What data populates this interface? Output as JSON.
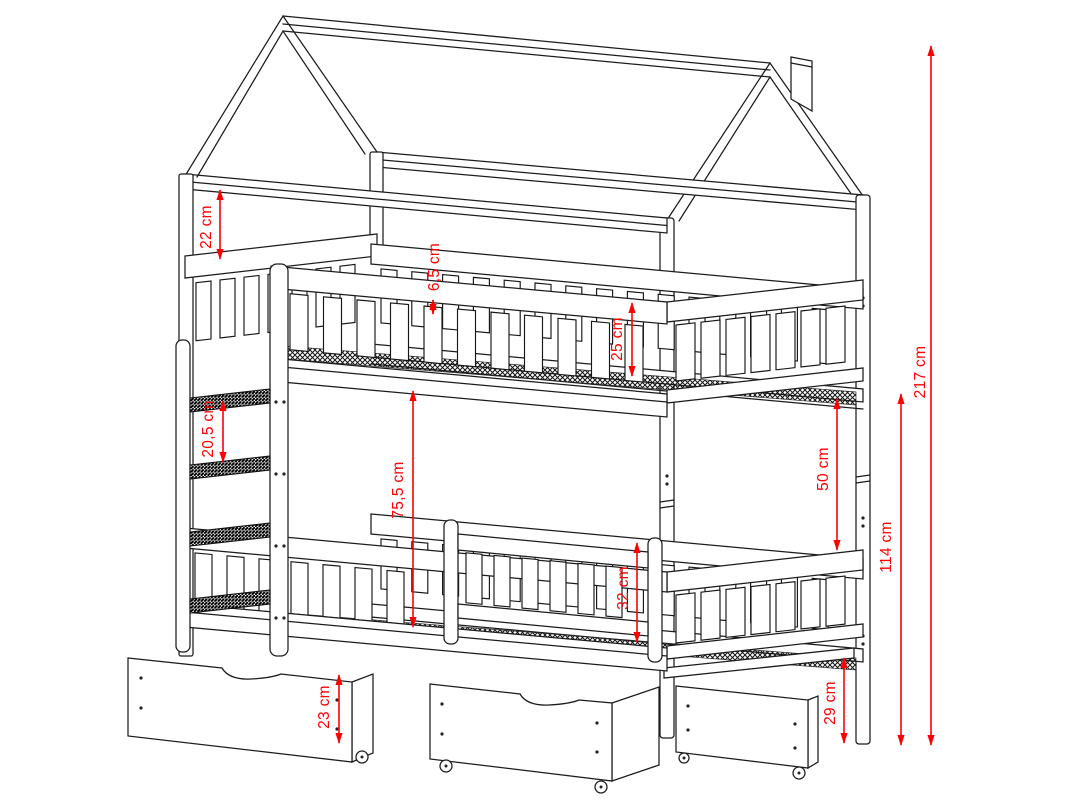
{
  "figure": {
    "type": "technical-drawing",
    "subject": "House-frame bunk bed with slatted guardrails, side ladder, chimney detail and two under-bed storage drawers on casters",
    "unit": "cm"
  },
  "colors": {
    "background": "#ffffff",
    "line_art": "#1c1c1c",
    "dimension_red": "#ff0000"
  },
  "dimensions": [
    {
      "id": "headboard-panel-height",
      "label": "22 cm",
      "x": 220,
      "y1": 189,
      "y2": 260,
      "lx": 207,
      "ly": 227
    },
    {
      "id": "top-rail-width",
      "label": "6,5 cm",
      "x": 433,
      "y1": 299,
      "y2": 315,
      "lx": 435,
      "ly": 267
    },
    {
      "id": "upper-guardrail-height",
      "label": "25 cm",
      "x": 632,
      "y1": 302,
      "y2": 377,
      "lx": 618,
      "ly": 339
    },
    {
      "id": "ladder-rung-spacing",
      "label": "20,5 cm",
      "x": 223,
      "y1": 400,
      "y2": 463,
      "lx": 209,
      "ly": 429
    },
    {
      "id": "bunk-clearance",
      "label": "75,5 cm",
      "x": 413,
      "y1": 390,
      "y2": 628,
      "lx": 399,
      "ly": 490
    },
    {
      "id": "upper-to-lower-gap",
      "label": "50 cm",
      "x": 837,
      "y1": 398,
      "y2": 551,
      "lx": 824,
      "ly": 469
    },
    {
      "id": "lower-guardrail-height",
      "label": "32 cm",
      "x": 637,
      "y1": 542,
      "y2": 643,
      "lx": 624,
      "ly": 588
    },
    {
      "id": "drawer-height",
      "label": "23 cm",
      "x": 339,
      "y1": 674,
      "y2": 744,
      "lx": 325,
      "ly": 707
    },
    {
      "id": "under-bed-clearance",
      "label": "29 cm",
      "x": 844,
      "y1": 657,
      "y2": 744,
      "lx": 831,
      "ly": 703
    },
    {
      "id": "lower-structure-height",
      "label": "114 cm",
      "x": 901,
      "y1": 393,
      "y2": 746,
      "lx": 887,
      "ly": 547
    },
    {
      "id": "total-height",
      "label": "217 cm",
      "x": 931,
      "y1": 45,
      "y2": 746,
      "lx": 921,
      "ly": 372
    }
  ]
}
